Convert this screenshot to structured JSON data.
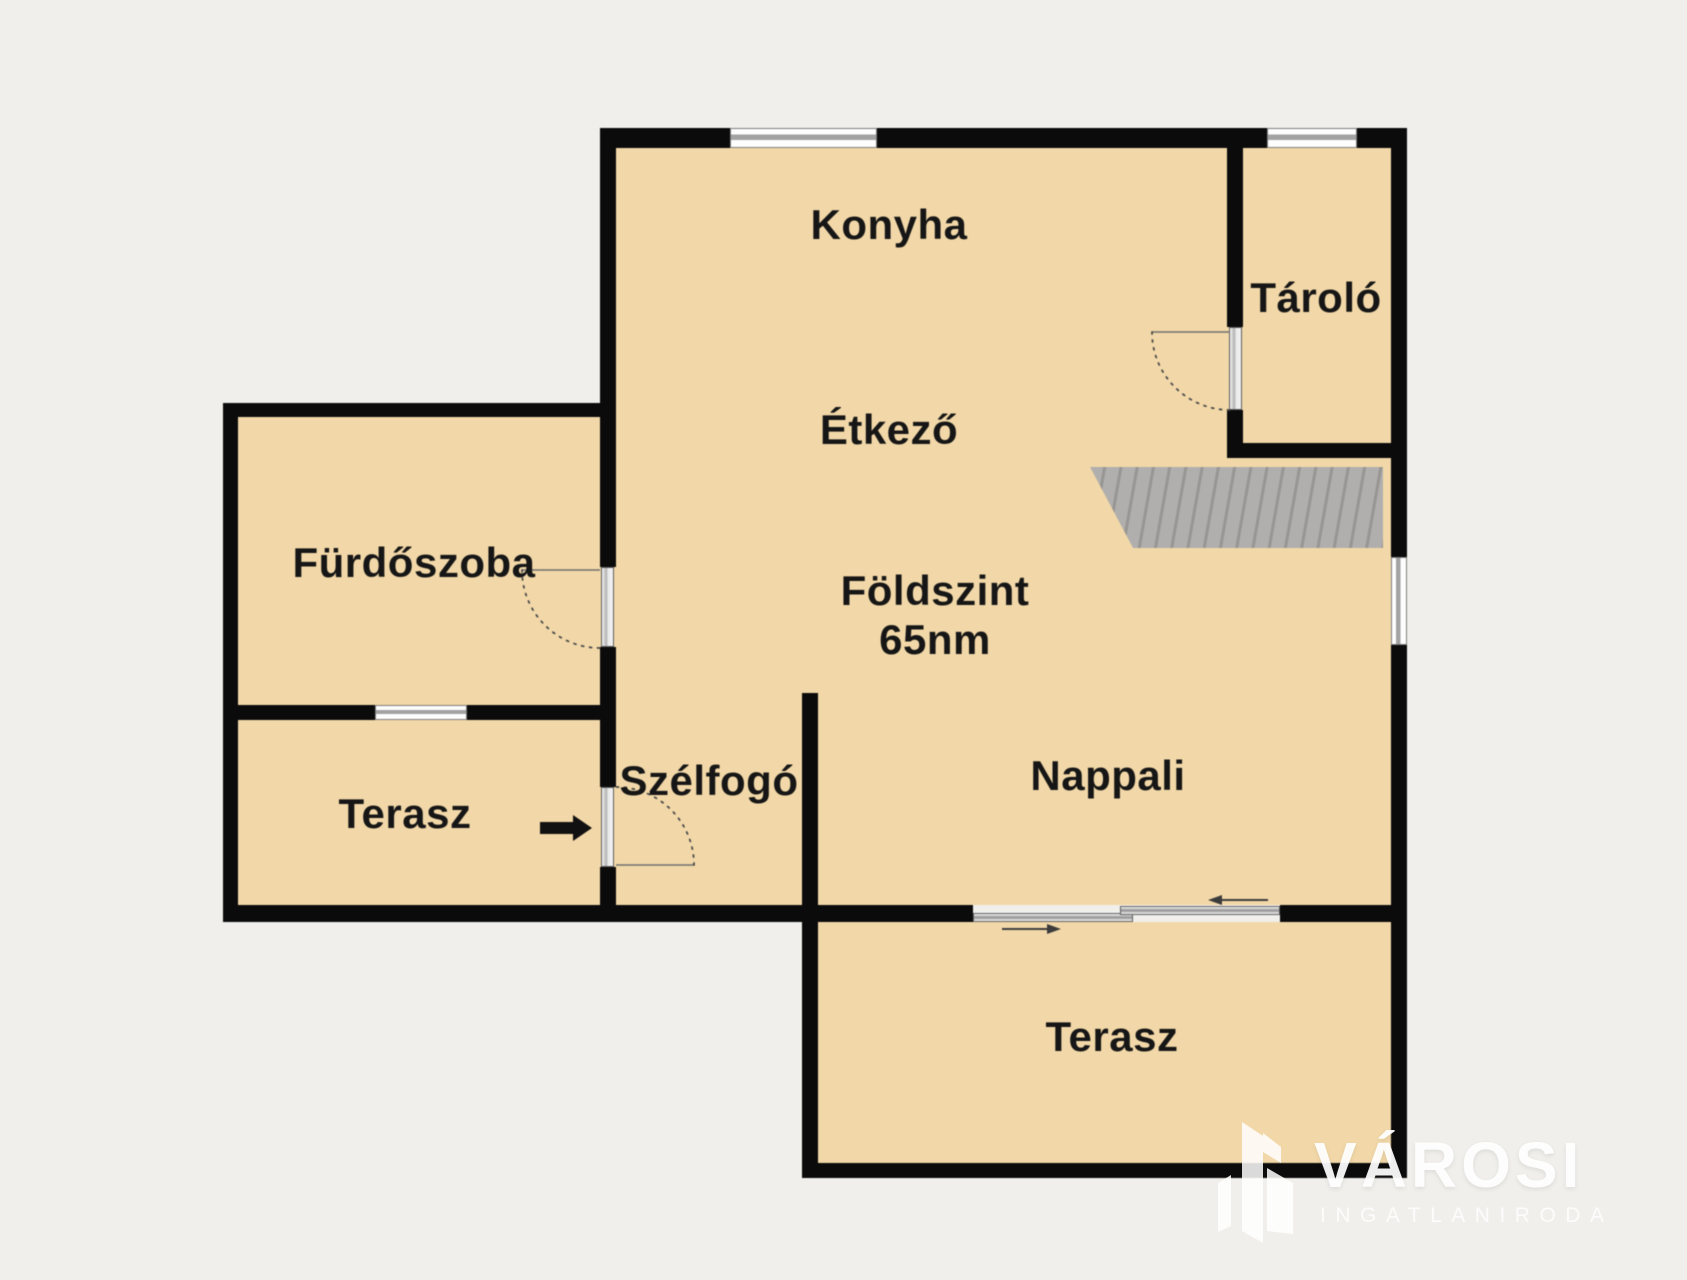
{
  "floor_plan": {
    "title": "Földszint",
    "area": "65nm",
    "rooms": {
      "konyha": "Konyha",
      "etkezo": "Étkező",
      "tarolo": "Tároló",
      "furdoszoba": "Fürdőszoba",
      "szelfogo": "Szélfogó",
      "nappali": "Nappali",
      "terasz_left": "Terasz",
      "terasz_bottom": "Terasz"
    }
  },
  "watermark": {
    "brand": "VÁROSI",
    "tagline": "INGATLANIRODA"
  },
  "icons": {
    "entrance_arrow": "solid right-pointing black arrow",
    "sliding_door_arrows": "thin opposing arrows on sliding terrace door",
    "door_swing": "dashed quarter-circle arc with leaf line",
    "stairs": "gray hatched tread band",
    "brand_logo": "white abstract building slabs"
  },
  "colors": {
    "background": "#f0efeb",
    "room_fill": "#f2d8a8",
    "wall": "#0b0b0b",
    "window_gray": "#a2a2a2",
    "door_gray": "#b0b0b0",
    "stairs_gray": "#a8a6a3",
    "label_text": "#161616",
    "watermark_white": "#ffffff"
  }
}
